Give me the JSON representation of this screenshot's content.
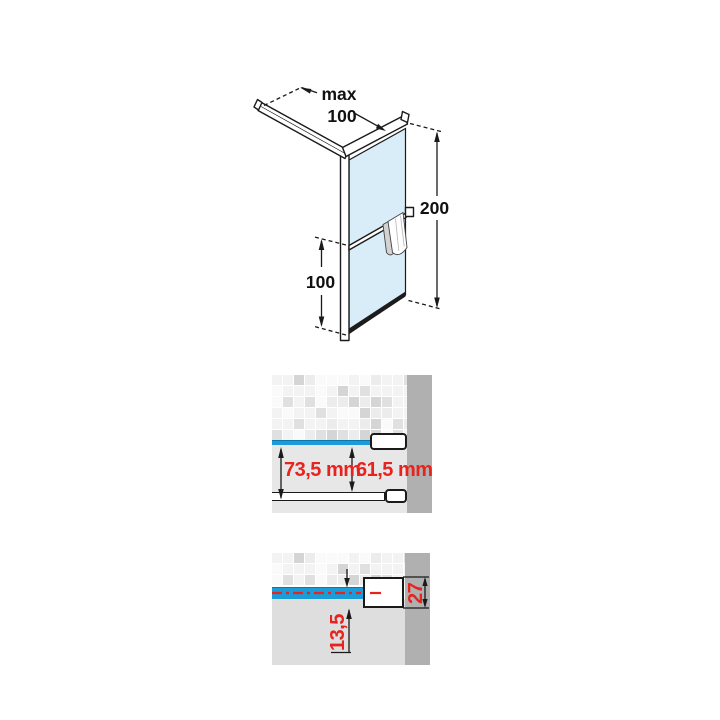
{
  "colors": {
    "accent_blue": "#1a9cd8",
    "accent_blue_dark": "#0e76ad",
    "dimension_red": "#e8231e",
    "wall_gray": "#b0b0b0",
    "glass_blue": "#d9edf8",
    "line_black": "#1a1a1a"
  },
  "isometric_view": {
    "bar_dim_label": "max",
    "bar_dim_value": "100",
    "height_dim": "200",
    "glass_height_dim": "100"
  },
  "plan_view": {
    "outer_dim": "73,5 mm",
    "inner_dim": "61,5 mm"
  },
  "section_view": {
    "centerline_offset_dim": "13,5",
    "profile_height_dim": "27"
  }
}
